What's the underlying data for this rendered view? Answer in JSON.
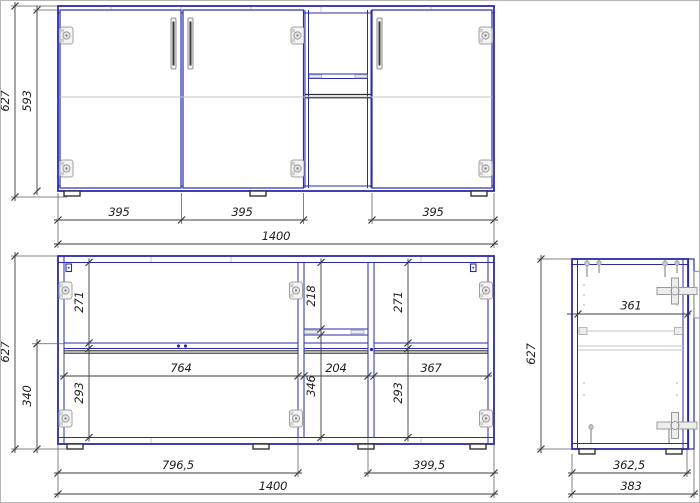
{
  "front": {
    "label": "front-view-closed",
    "dims": {
      "total_height": "627",
      "door_height": "593",
      "door1_width": "395",
      "door2_width": "395",
      "door3_width": "395",
      "total_width": "1400"
    }
  },
  "internal": {
    "label": "front-view-internal",
    "dims": {
      "total_height": "627",
      "base_height": "340",
      "left_upper_height": "271",
      "left_lower_height": "293",
      "mid_upper_height": "218",
      "mid_lower_height": "346",
      "right_upper_height": "271",
      "right_lower_height": "293",
      "left_inner_width": "764",
      "mid_inner_width": "204",
      "right_inner_width": "367",
      "left_section_width": "796,5",
      "right_section_width": "399,5",
      "total_width": "1400"
    }
  },
  "side": {
    "label": "side-view",
    "dims": {
      "total_height": "627",
      "inner_depth": "361",
      "body_depth": "362,5",
      "total_depth": "383"
    }
  },
  "colors": {
    "panel_outline": "#2a2ab0",
    "dimension": "#3c3c3c",
    "hardware_light": "#b0b0b0",
    "hardware_dark": "#2f2f2f",
    "background": "#ffffff"
  }
}
